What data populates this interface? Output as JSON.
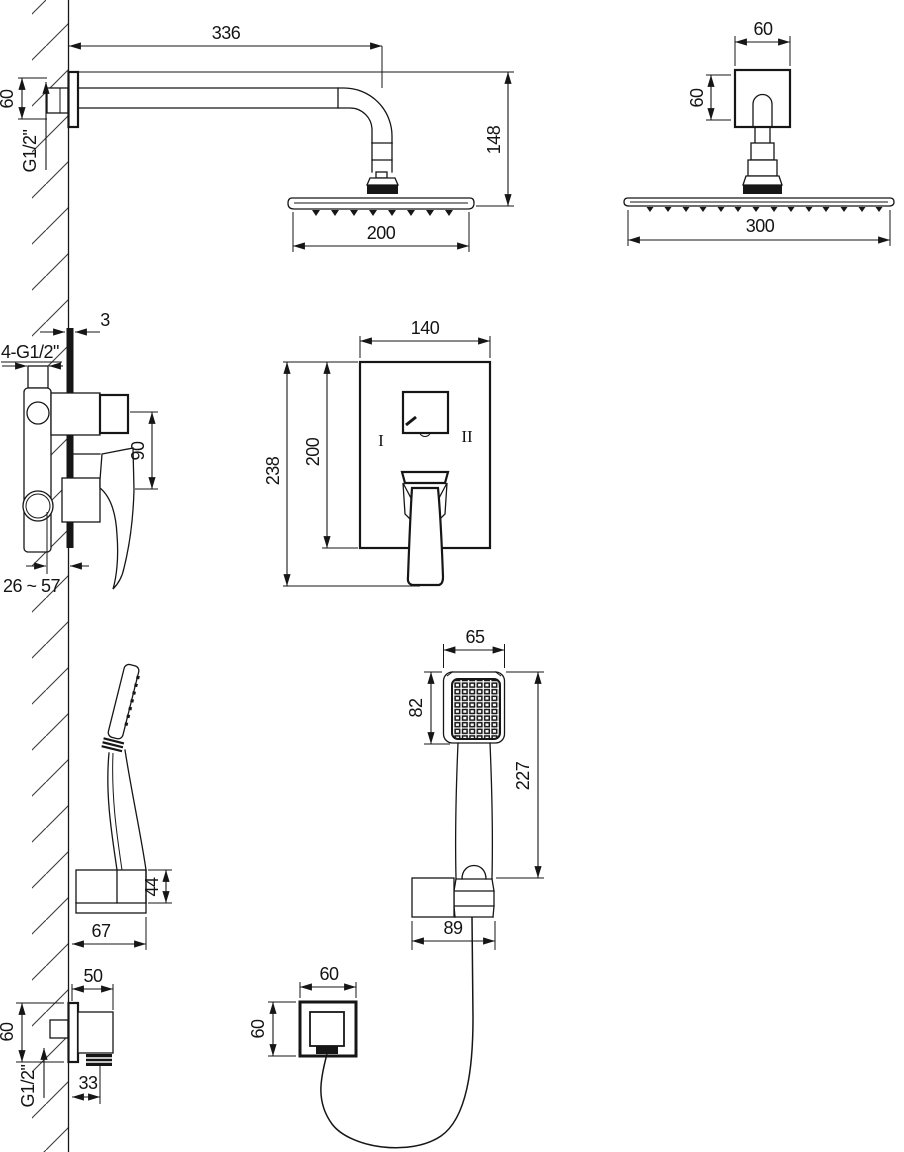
{
  "meta": {
    "drawing_type": "concealed shower set installation dimensions",
    "line_color": "#161616",
    "background_color": "#ffffff"
  },
  "dims": {
    "wall_shower": {
      "arm_length": "336",
      "flange": "60",
      "thread": "G1/2\"",
      "drop": "148",
      "head": "200"
    },
    "ceiling_shower": {
      "flange_w": "60",
      "flange_h": "60",
      "head": "300"
    },
    "mixer_side": {
      "tile": "3",
      "ports": "4-G1/2\"",
      "spacing": "90",
      "depth_range": "26 ~ 57"
    },
    "mixer_front": {
      "width": "140",
      "height": "238",
      "plate": "200",
      "pos_left": "I",
      "pos_right": "II"
    },
    "holder_side": {
      "height": "44",
      "depth": "67"
    },
    "handshower": {
      "head_w": "65",
      "head_h": "82",
      "length": "227",
      "bracket": "89"
    },
    "outlet_side": {
      "depth": "50",
      "height": "60",
      "offset": "33",
      "thread": "G1/2\""
    },
    "outlet_front": {
      "width": "60",
      "height": "60"
    }
  }
}
